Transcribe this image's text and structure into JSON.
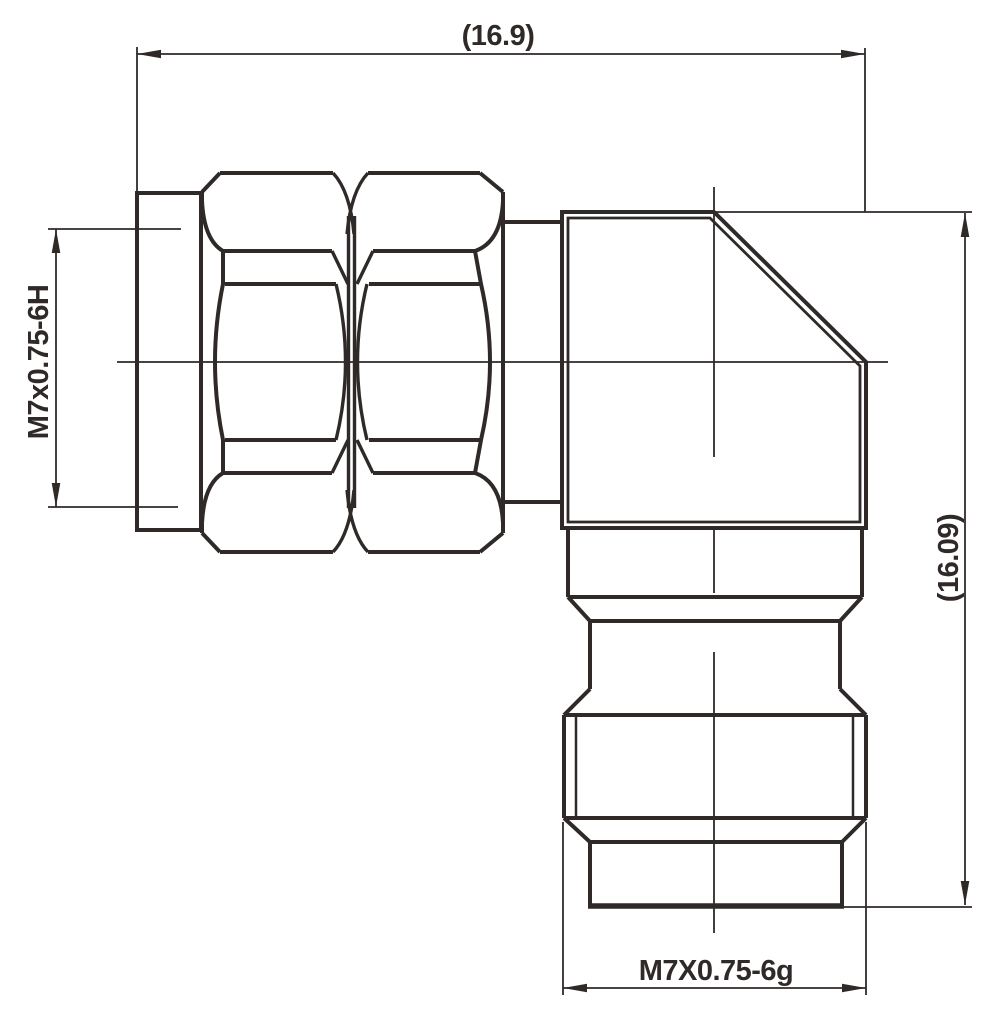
{
  "drawing": {
    "background": "#ffffff",
    "stroke_color": "#2f2a28",
    "labels": {
      "top_width": "(16.9)",
      "right_height": "(16.09)",
      "left_thread": "M7x0.75-6H",
      "bottom_thread": "M7X0.75-6g"
    }
  }
}
